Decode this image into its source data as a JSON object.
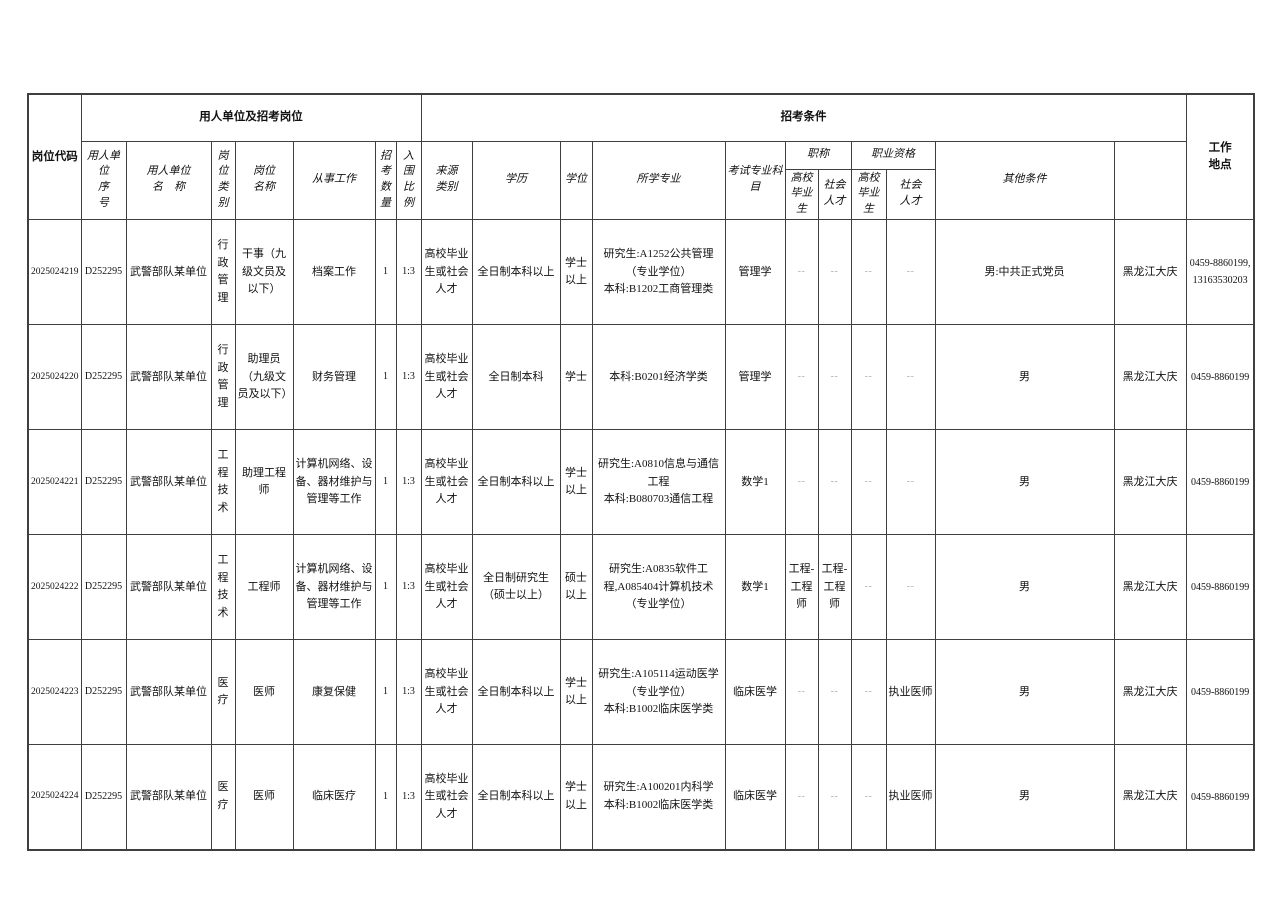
{
  "table": {
    "header": {
      "job_code": "岗位代码",
      "group_employer": "用人单位及招考岗位",
      "group_conditions": "招考条件",
      "work_location": "工作\n地点",
      "phone": "咨询电话",
      "sub": {
        "employer_no": "用人单\n位\n序\n号",
        "employer_name": "用人单位\n名　称",
        "post_category": "岗\n位\n类\n别",
        "post_name": "岗位\n名称",
        "job_duty": "从事工作",
        "recruit_count": "招\n考\n数\n量",
        "ratio": "入\n围\n比\n例",
        "source_type": "来源\n类别",
        "education": "学历",
        "degree": "学位",
        "major": "所学专业",
        "exam_subject": "考试专业科\n目",
        "title_group": "职称",
        "qualification_group": "职业资格",
        "grad": "高校\n毕业生",
        "social": "社会\n人才",
        "other_conditions": "其他条件"
      }
    },
    "rows": [
      {
        "job_code": "2025024219",
        "employer_no": "D252295",
        "employer_name": "武警部队某单位",
        "post_category": "行政管理",
        "post_name": "干事（九级文员及以下）",
        "job_duty": "档案工作",
        "recruit_count": "1",
        "ratio": "1:3",
        "source_type": "高校毕业生或社会人才",
        "education": "全日制本科以上",
        "degree": "学士以上",
        "major": "研究生:A1252公共管理（专业学位）\n本科:B1202工商管理类",
        "exam_subject": "管理学",
        "title_grad": "--",
        "title_social": "--",
        "qual_grad": "--",
        "qual_social": "--",
        "other_conditions": "男:中共正式党员",
        "work_location": "黑龙江大庆",
        "phone": "0459-8860199,13163530203"
      },
      {
        "job_code": "2025024220",
        "employer_no": "D252295",
        "employer_name": "武警部队某单位",
        "post_category": "行政管理",
        "post_name": "助理员（九级文员及以下）",
        "job_duty": "财务管理",
        "recruit_count": "1",
        "ratio": "1:3",
        "source_type": "高校毕业生或社会人才",
        "education": "全日制本科",
        "degree": "学士",
        "major": "本科:B0201经济学类",
        "exam_subject": "管理学",
        "title_grad": "--",
        "title_social": "--",
        "qual_grad": "--",
        "qual_social": "--",
        "other_conditions": "男",
        "work_location": "黑龙江大庆",
        "phone": "0459-8860199"
      },
      {
        "job_code": "2025024221",
        "employer_no": "D252295",
        "employer_name": "武警部队某单位",
        "post_category": "工程技术",
        "post_name": "助理工程师",
        "job_duty": "计算机网络、设备、器材维护与管理等工作",
        "recruit_count": "1",
        "ratio": "1:3",
        "source_type": "高校毕业生或社会人才",
        "education": "全日制本科以上",
        "degree": "学士以上",
        "major": "研究生:A0810信息与通信工程\n本科:B080703通信工程",
        "exam_subject": "数学1",
        "title_grad": "--",
        "title_social": "--",
        "qual_grad": "--",
        "qual_social": "--",
        "other_conditions": "男",
        "work_location": "黑龙江大庆",
        "phone": "0459-8860199"
      },
      {
        "job_code": "2025024222",
        "employer_no": "D252295",
        "employer_name": "武警部队某单位",
        "post_category": "工程技术",
        "post_name": "工程师",
        "job_duty": "计算机网络、设备、器材维护与管理等工作",
        "recruit_count": "1",
        "ratio": "1:3",
        "source_type": "高校毕业生或社会人才",
        "education": "全日制研究生（硕士以上）",
        "degree": "硕士以上",
        "major": "研究生:A0835软件工程,A085404计算机技术（专业学位）",
        "exam_subject": "数学1",
        "title_grad": "工程-工程师",
        "title_social": "工程-工程师",
        "qual_grad": "--",
        "qual_social": "--",
        "other_conditions": "男",
        "work_location": "黑龙江大庆",
        "phone": "0459-8860199"
      },
      {
        "job_code": "2025024223",
        "employer_no": "D252295",
        "employer_name": "武警部队某单位",
        "post_category": "医疗",
        "post_name": "医师",
        "job_duty": "康复保健",
        "recruit_count": "1",
        "ratio": "1:3",
        "source_type": "高校毕业生或社会人才",
        "education": "全日制本科以上",
        "degree": "学士以上",
        "major": "研究生:A105114运动医学（专业学位）\n本科:B1002临床医学类",
        "exam_subject": "临床医学",
        "title_grad": "--",
        "title_social": "--",
        "qual_grad": "--",
        "qual_social": "执业医师",
        "other_conditions": "男",
        "work_location": "黑龙江大庆",
        "phone": "0459-8860199"
      },
      {
        "job_code": "2025024224",
        "employer_no": "D252295",
        "employer_name": "武警部队某单位",
        "post_category": "医疗",
        "post_name": "医师",
        "job_duty": "临床医疗",
        "recruit_count": "1",
        "ratio": "1:3",
        "source_type": "高校毕业生或社会人才",
        "education": "全日制本科以上",
        "degree": "学士以上",
        "major": "研究生:A100201内科学\n本科:B1002临床医学类",
        "exam_subject": "临床医学",
        "title_grad": "--",
        "title_social": "--",
        "qual_grad": "--",
        "qual_social": "执业医师",
        "other_conditions": "男",
        "work_location": "黑龙江大庆",
        "phone": "0459-8860199"
      }
    ]
  }
}
